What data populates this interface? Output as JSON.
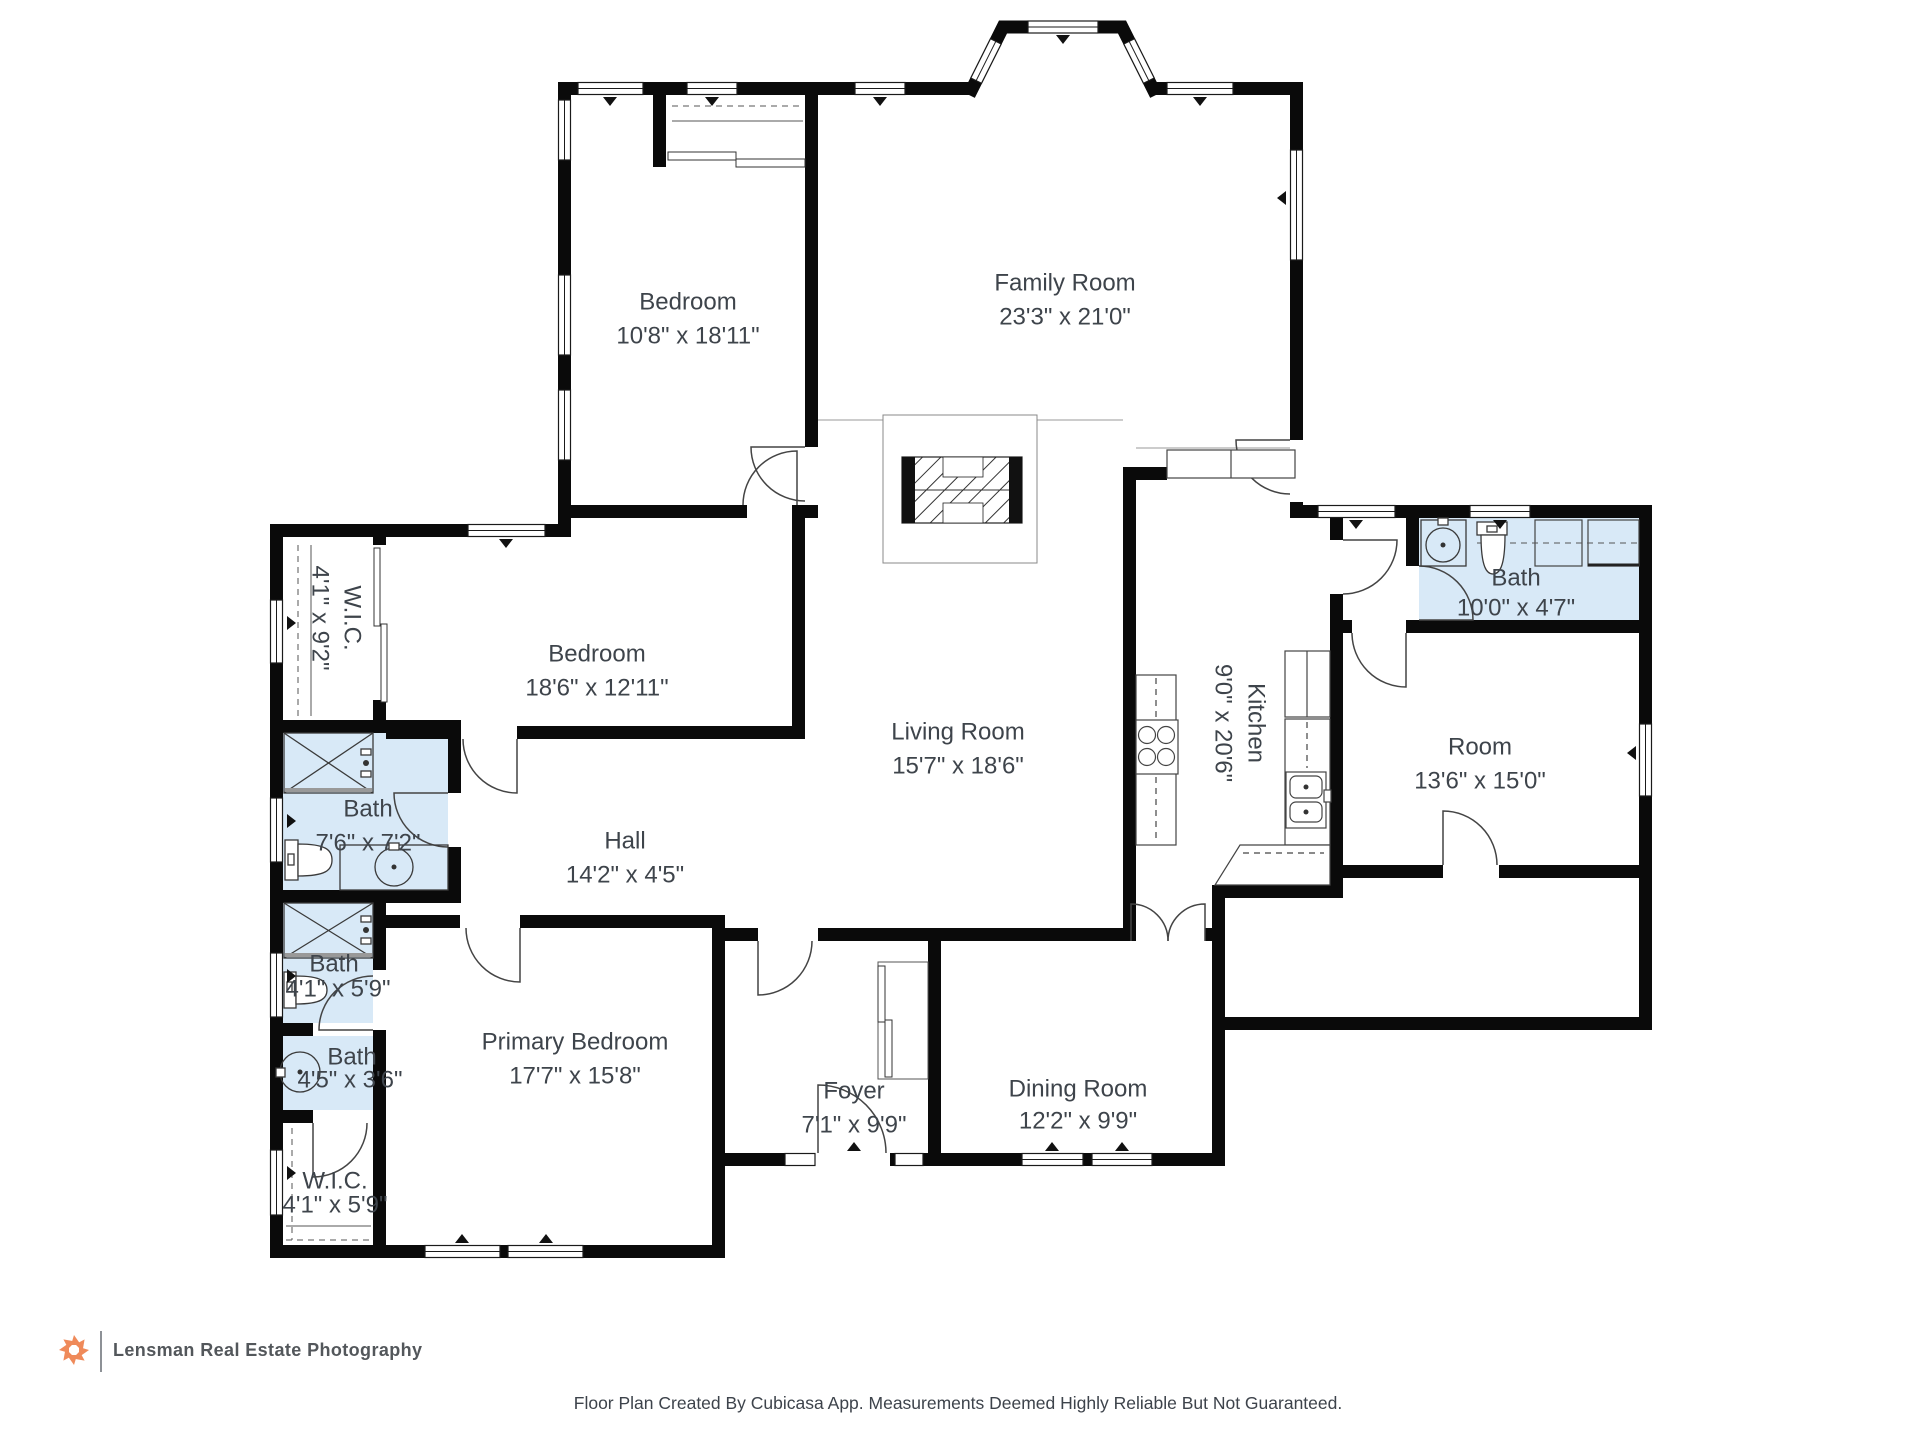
{
  "rooms": {
    "bedroom_top": {
      "name": "Bedroom",
      "dims": "10'8\" x 18'11\""
    },
    "family_room": {
      "name": "Family Room",
      "dims": "23'3\" x 21'0\""
    },
    "wic_upper": {
      "name": "W.I.C.",
      "dims": "4'1\" x 9'2\""
    },
    "bedroom_mid": {
      "name": "Bedroom",
      "dims": "18'6\" x 12'11\""
    },
    "bath_main": {
      "name": "Bath",
      "dims": "7'6\" x 7'2\""
    },
    "hall": {
      "name": "Hall",
      "dims": "14'2\" x 4'5\""
    },
    "bath_small": {
      "name": "Bath",
      "dims": "4'1\" x 5'9\""
    },
    "bath_vanity": {
      "name": "Bath",
      "dims": "4'5\" x 3'6\""
    },
    "wic_lower": {
      "name": "W.I.C.",
      "dims": "4'1\" x 5'9\""
    },
    "primary_bedroom": {
      "name": "Primary Bedroom",
      "dims": "17'7\" x 15'8\""
    },
    "living_room": {
      "name": "Living Room",
      "dims": "15'7\" x 18'6\""
    },
    "foyer": {
      "name": "Foyer",
      "dims": "7'1\" x 9'9\""
    },
    "dining_room": {
      "name": "Dining Room",
      "dims": "12'2\" x 9'9\""
    },
    "kitchen": {
      "name": "Kitchen",
      "dims": "9'0\" x 20'6\""
    },
    "bath_right": {
      "name": "Bath",
      "dims": "10'0\" x 4'7\""
    },
    "room_right": {
      "name": "Room",
      "dims": "13'6\" x 15'0\""
    }
  },
  "footer": {
    "logo_text": "Lensman Real Estate Photography",
    "disclaimer": "Floor Plan Created By Cubicasa App. Measurements Deemed Highly Reliable But Not Guaranteed."
  },
  "colors": {
    "wall": "#0a0a0a",
    "bath_fill": "#d8e9f7",
    "text": "#3e444b",
    "logo_accent": "#ef8a5a"
  }
}
